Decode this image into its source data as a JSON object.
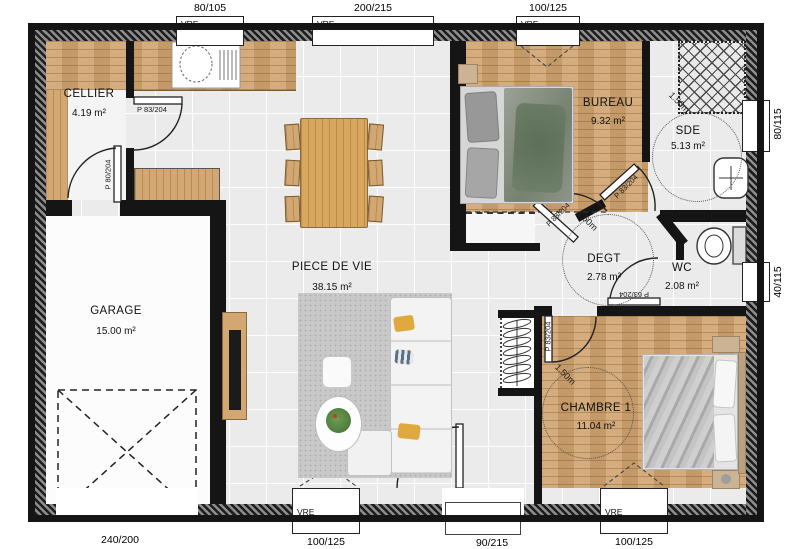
{
  "rooms": {
    "cellier": {
      "name": "CELLIER",
      "area": "4.19 m²"
    },
    "garage": {
      "name": "GARAGE",
      "area": "15.00 m²"
    },
    "piece_de_vie": {
      "name": "PIECE DE VIE",
      "area": "38.15 m²"
    },
    "bureau": {
      "name": "BUREAU",
      "area": "9.32 m²"
    },
    "sde": {
      "name": "SDE",
      "area": "5.13 m²"
    },
    "degt": {
      "name": "DEGT",
      "area": "2.78 m²"
    },
    "wc": {
      "name": "WC",
      "area": "2.08 m²"
    },
    "chambre1": {
      "name": "CHAMBRE 1",
      "area": "11.04 m²"
    }
  },
  "windows": {
    "vre_label": "VRE",
    "top_cellier": "80/105",
    "top_living": "200/215",
    "top_bureau": "100/125",
    "right_sde": "80/115",
    "right_wc": "40/115",
    "bottom_living": "100/125",
    "bottom_chambre": "100/125"
  },
  "doors": {
    "garage_door": "240/200",
    "entry": "90/215",
    "cellier": "P 83/204",
    "cellier_garage": "P 80/204",
    "bureau": "P 83/204",
    "sde": "P 83/204",
    "wc": "P 63/204",
    "chambre": "P 83/204"
  },
  "annotations": {
    "clearance": "1.50m"
  },
  "colors": {
    "wall": "#151515",
    "wood": "#cfa36e",
    "tile": "#ebebeb",
    "pillow_accent": "#e0a93f"
  }
}
